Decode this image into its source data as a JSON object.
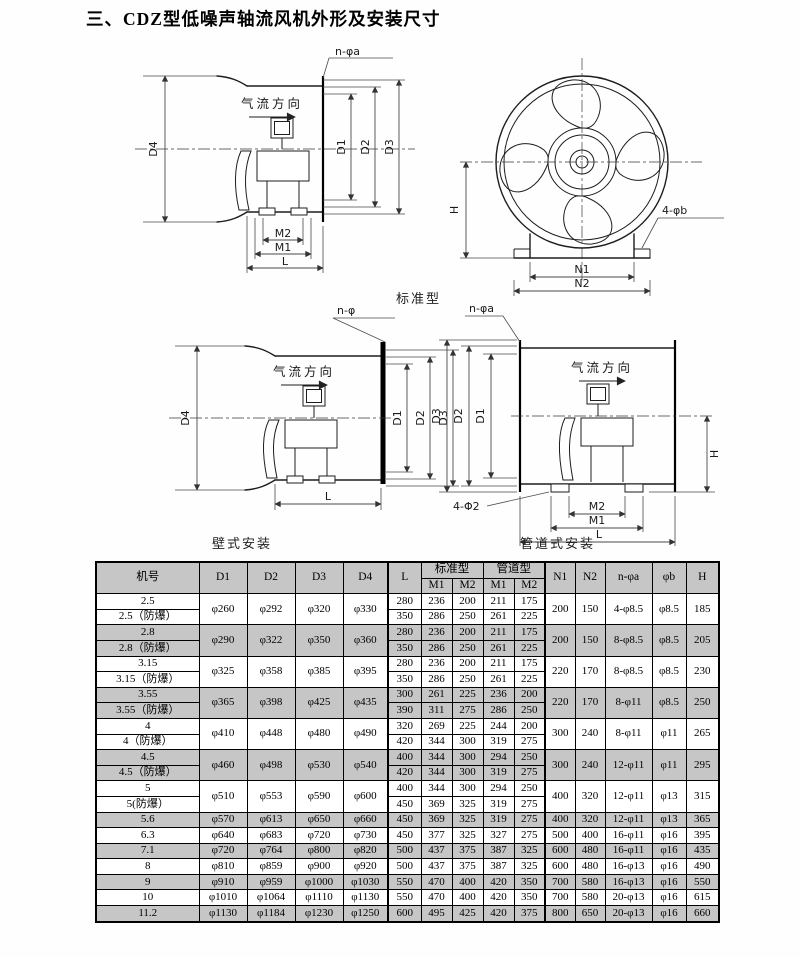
{
  "page": {
    "title": "三、CDZ型低噪声轴流风机外形及安装尺寸"
  },
  "colors": {
    "row_shade": "#c6c6c6",
    "line": "#1d1d1d"
  },
  "figures": {
    "airflow": "气流方向",
    "standard_caption": "标准型",
    "wall_caption": "壁式安装",
    "duct_caption": "管道式安装",
    "fig1": {
      "bolt": "n-φa",
      "d1": "D1",
      "d2": "D2",
      "d3": "D3",
      "d4": "D4",
      "m1": "M1",
      "m2": "M2",
      "l": "L"
    },
    "fig2": {
      "bolt": "4-φb",
      "h": "H",
      "n1": "N1",
      "n2": "N2"
    },
    "fig3": {
      "bolt": "n-φ",
      "d1": "D1",
      "d2": "D2",
      "d3": "D3",
      "d4": "D4",
      "l": "L"
    },
    "fig4": {
      "bolt": "n-φa",
      "feet_bolt": "4-Φ2",
      "d1": "D1",
      "d2": "D2",
      "d3": "D3",
      "m1": "M1",
      "m2": "M2",
      "l": "L",
      "h": "H"
    }
  },
  "table": {
    "header": {
      "model": "机号",
      "d1": "D1",
      "d2": "D2",
      "d3": "D3",
      "d4": "D4",
      "l": "L",
      "std": "标准型",
      "duct": "管道型",
      "m1": "M1",
      "m2": "M2",
      "n1": "N1",
      "n2": "N2",
      "na": "n-φa",
      "b": "φb",
      "h": "H"
    },
    "rows": [
      {
        "shaded": false,
        "models": [
          "2.5",
          "2.5（防爆）"
        ],
        "d": [
          "φ260",
          "φ292",
          "φ320",
          "φ330"
        ],
        "sub": [
          [
            "280",
            "236",
            "200",
            "211",
            "175"
          ],
          [
            "350",
            "286",
            "250",
            "261",
            "225"
          ]
        ],
        "tail": [
          "200",
          "150",
          "4-φ8.5",
          "φ8.5",
          "185"
        ]
      },
      {
        "shaded": true,
        "models": [
          "2.8",
          "2.8（防爆）"
        ],
        "d": [
          "φ290",
          "φ322",
          "φ350",
          "φ360"
        ],
        "sub": [
          [
            "280",
            "236",
            "200",
            "211",
            "175"
          ],
          [
            "350",
            "286",
            "250",
            "261",
            "225"
          ]
        ],
        "tail": [
          "200",
          "150",
          "8-φ8.5",
          "φ8.5",
          "205"
        ]
      },
      {
        "shaded": false,
        "models": [
          "3.15",
          "3.15（防爆）"
        ],
        "d": [
          "φ325",
          "φ358",
          "φ385",
          "φ395"
        ],
        "sub": [
          [
            "280",
            "236",
            "200",
            "211",
            "175"
          ],
          [
            "350",
            "286",
            "250",
            "261",
            "225"
          ]
        ],
        "tail": [
          "220",
          "170",
          "8-φ8.5",
          "φ8.5",
          "230"
        ]
      },
      {
        "shaded": true,
        "models": [
          "3.55",
          "3.55（防爆）"
        ],
        "d": [
          "φ365",
          "φ398",
          "φ425",
          "φ435"
        ],
        "sub": [
          [
            "300",
            "261",
            "225",
            "236",
            "200"
          ],
          [
            "390",
            "311",
            "275",
            "286",
            "250"
          ]
        ],
        "tail": [
          "220",
          "170",
          "8-φ11",
          "φ8.5",
          "250"
        ]
      },
      {
        "shaded": false,
        "models": [
          "4",
          "4（防爆）"
        ],
        "d": [
          "φ410",
          "φ448",
          "φ480",
          "φ490"
        ],
        "sub": [
          [
            "320",
            "269",
            "225",
            "244",
            "200"
          ],
          [
            "420",
            "344",
            "300",
            "319",
            "275"
          ]
        ],
        "tail": [
          "300",
          "240",
          "8-φ11",
          "φ11",
          "265"
        ]
      },
      {
        "shaded": true,
        "models": [
          "4.5",
          "4.5（防爆）"
        ],
        "d": [
          "φ460",
          "φ498",
          "φ530",
          "φ540"
        ],
        "sub": [
          [
            "400",
            "344",
            "300",
            "294",
            "250"
          ],
          [
            "420",
            "344",
            "300",
            "319",
            "275"
          ]
        ],
        "tail": [
          "300",
          "240",
          "12-φ11",
          "φ11",
          "295"
        ]
      },
      {
        "shaded": false,
        "models": [
          "5",
          "5(防爆）"
        ],
        "d": [
          "φ510",
          "φ553",
          "φ590",
          "φ600"
        ],
        "sub": [
          [
            "400",
            "344",
            "300",
            "294",
            "250"
          ],
          [
            "450",
            "369",
            "325",
            "319",
            "275"
          ]
        ],
        "tail": [
          "400",
          "320",
          "12-φ11",
          "φ13",
          "315"
        ]
      },
      {
        "shaded": true,
        "models": [
          "5.6"
        ],
        "d": [
          "φ570",
          "φ613",
          "φ650",
          "φ660"
        ],
        "sub": [
          [
            "450",
            "369",
            "325",
            "319",
            "275"
          ]
        ],
        "tail": [
          "400",
          "320",
          "12-φ11",
          "φ13",
          "365"
        ]
      },
      {
        "shaded": false,
        "models": [
          "6.3"
        ],
        "d": [
          "φ640",
          "φ683",
          "φ720",
          "φ730"
        ],
        "sub": [
          [
            "450",
            "377",
            "325",
            "327",
            "275"
          ]
        ],
        "tail": [
          "500",
          "400",
          "16-φ11",
          "φ16",
          "395"
        ]
      },
      {
        "shaded": true,
        "models": [
          "7.1"
        ],
        "d": [
          "φ720",
          "φ764",
          "φ800",
          "φ820"
        ],
        "sub": [
          [
            "500",
            "437",
            "375",
            "387",
            "325"
          ]
        ],
        "tail": [
          "600",
          "480",
          "16-φ11",
          "φ16",
          "435"
        ]
      },
      {
        "shaded": false,
        "models": [
          "8"
        ],
        "d": [
          "φ810",
          "φ859",
          "φ900",
          "φ920"
        ],
        "sub": [
          [
            "500",
            "437",
            "375",
            "387",
            "325"
          ]
        ],
        "tail": [
          "600",
          "480",
          "16-φ13",
          "φ16",
          "490"
        ]
      },
      {
        "shaded": true,
        "models": [
          "9"
        ],
        "d": [
          "φ910",
          "φ959",
          "φ1000",
          "φ1030"
        ],
        "sub": [
          [
            "550",
            "470",
            "400",
            "420",
            "350"
          ]
        ],
        "tail": [
          "700",
          "580",
          "16-φ13",
          "φ16",
          "550"
        ]
      },
      {
        "shaded": false,
        "models": [
          "10"
        ],
        "d": [
          "φ1010",
          "φ1064",
          "φ1110",
          "φ1130"
        ],
        "sub": [
          [
            "550",
            "470",
            "400",
            "420",
            "350"
          ]
        ],
        "tail": [
          "700",
          "580",
          "20-φ13",
          "φ16",
          "615"
        ]
      },
      {
        "shaded": true,
        "models": [
          "11.2"
        ],
        "d": [
          "φ1130",
          "φ1184",
          "φ1230",
          "φ1250"
        ],
        "sub": [
          [
            "600",
            "495",
            "425",
            "420",
            "375"
          ]
        ],
        "tail": [
          "800",
          "650",
          "20-φ13",
          "φ16",
          "660"
        ]
      }
    ]
  }
}
